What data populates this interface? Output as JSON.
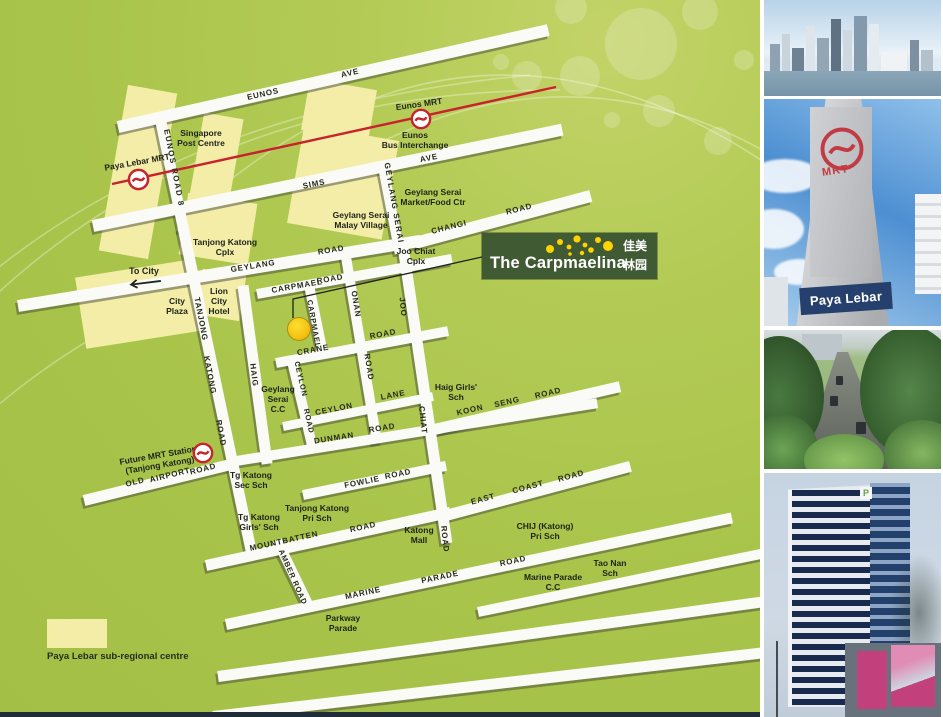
{
  "map": {
    "legend": {
      "label": "Paya Lebar sub-regional centre",
      "swatch_color": "#f3eda8"
    },
    "to_city": {
      "label": "To City"
    },
    "callout": {
      "title": "The Carpmaelina",
      "chinese_line1": "佳美",
      "chinese_line2": "林园",
      "bg_color": "#405a34",
      "dot_color": "#ffd200"
    },
    "mrt_line_color": "#c8232c",
    "road_labels": [
      {
        "t": "EUNOS",
        "x": 263,
        "y": 94,
        "rot": -12.7
      },
      {
        "t": "AVE",
        "x": 350,
        "y": 73,
        "rot": -12.7
      },
      {
        "t": "SIMS",
        "x": 314,
        "y": 184,
        "rot": -11.6
      },
      {
        "t": "AVE",
        "x": 429,
        "y": 158,
        "rot": -11.6
      },
      {
        "t": "GEYLANG",
        "x": 253,
        "y": 266,
        "rot": -9.2
      },
      {
        "t": "ROAD",
        "x": 331,
        "y": 250,
        "rot": -9.2
      },
      {
        "t": "CHANGI",
        "x": 449,
        "y": 227,
        "rot": -14
      },
      {
        "t": "ROAD",
        "x": 519,
        "y": 209,
        "rot": -14
      },
      {
        "t": "EUNOS ROAD 8",
        "x": 174,
        "y": 168,
        "rot": 79,
        "ls": 1.5
      },
      {
        "t": "GEYLANG SERAI",
        "x": 394,
        "y": 203,
        "rot": 80,
        "ls": 1.2
      },
      {
        "t": "CARPMAEL",
        "x": 297,
        "y": 286,
        "rot": -10
      },
      {
        "t": "ROAD",
        "x": 330,
        "y": 279,
        "rot": -10
      },
      {
        "t": "TANJONG",
        "x": 201,
        "y": 319,
        "rot": 79
      },
      {
        "t": "KATONG",
        "x": 210,
        "y": 375,
        "rot": 79
      },
      {
        "t": "ROAD",
        "x": 221,
        "y": 433,
        "rot": 79
      },
      {
        "t": "HAIG",
        "x": 254,
        "y": 375,
        "rot": 83
      },
      {
        "t": "CARPMAEL",
        "x": 314,
        "y": 324,
        "rot": 80,
        "fs": 7.5
      },
      {
        "t": "ONAN",
        "x": 356,
        "y": 304,
        "rot": 81
      },
      {
        "t": "ROAD",
        "x": 369,
        "y": 367,
        "rot": 81
      },
      {
        "t": "JOO",
        "x": 403,
        "y": 307,
        "rot": 84
      },
      {
        "t": "CHIAT",
        "x": 423,
        "y": 420,
        "rot": 84
      },
      {
        "t": "ROAD",
        "x": 445,
        "y": 539,
        "rot": 84
      },
      {
        "t": "CRANE",
        "x": 313,
        "y": 350,
        "rot": -10.5
      },
      {
        "t": "ROAD",
        "x": 383,
        "y": 334,
        "rot": -10.5
      },
      {
        "t": "CEYLON",
        "x": 301,
        "y": 379,
        "rot": 77,
        "fs": 7.5
      },
      {
        "t": "ROAD",
        "x": 309,
        "y": 421,
        "rot": 77,
        "fs": 7.5
      },
      {
        "t": "CEYLON",
        "x": 334,
        "y": 409,
        "rot": -11.3
      },
      {
        "t": "LANE",
        "x": 393,
        "y": 395,
        "rot": -11.3
      },
      {
        "t": "KOON",
        "x": 470,
        "y": 410,
        "rot": -13
      },
      {
        "t": "SENG",
        "x": 507,
        "y": 402,
        "rot": -13
      },
      {
        "t": "ROAD",
        "x": 548,
        "y": 393,
        "rot": -13
      },
      {
        "t": "DUNMAN",
        "x": 334,
        "y": 438,
        "rot": -9.1
      },
      {
        "t": "ROAD",
        "x": 382,
        "y": 428,
        "rot": -9.1
      },
      {
        "t": "OLD",
        "x": 135,
        "y": 482,
        "rot": -13.8
      },
      {
        "t": "AIRPORT",
        "x": 170,
        "y": 475,
        "rot": -13.8
      },
      {
        "t": "ROAD",
        "x": 203,
        "y": 469,
        "rot": -13.8
      },
      {
        "t": "FOWLIE",
        "x": 362,
        "y": 482,
        "rot": -11.5
      },
      {
        "t": "ROAD",
        "x": 398,
        "y": 474,
        "rot": -11.5
      },
      {
        "t": "EAST",
        "x": 483,
        "y": 499,
        "rot": -14.9
      },
      {
        "t": "COAST",
        "x": 528,
        "y": 487,
        "rot": -14.9
      },
      {
        "t": "ROAD",
        "x": 571,
        "y": 476,
        "rot": -14.9
      },
      {
        "t": "MOUNTBATTEN",
        "x": 284,
        "y": 541,
        "rot": -12.3
      },
      {
        "t": "ROAD",
        "x": 363,
        "y": 527,
        "rot": -12.3
      },
      {
        "t": "AMBER ROAD",
        "x": 293,
        "y": 577,
        "rot": 66,
        "fs": 7.5
      },
      {
        "t": "MARINE",
        "x": 363,
        "y": 593,
        "rot": -11.9
      },
      {
        "t": "PARADE",
        "x": 440,
        "y": 577,
        "rot": -11.9
      },
      {
        "t": "ROAD",
        "x": 513,
        "y": 561,
        "rot": -11.9
      }
    ],
    "poi_labels": [
      {
        "lines": [
          "Singapore",
          "Post Centre"
        ],
        "x": 201,
        "y": 138
      },
      {
        "lines": [
          "Paya Lebar MRT"
        ],
        "x": 137,
        "y": 162,
        "rot": -10
      },
      {
        "lines": [
          "Eunos MRT"
        ],
        "x": 419,
        "y": 104,
        "rot": -8
      },
      {
        "lines": [
          "Eunos",
          "Bus Interchange"
        ],
        "x": 415,
        "y": 140
      },
      {
        "lines": [
          "Geylang Serai",
          "Market/Food Ctr"
        ],
        "x": 433,
        "y": 197
      },
      {
        "lines": [
          "Geylang Serai",
          "Malay Village"
        ],
        "x": 361,
        "y": 220
      },
      {
        "lines": [
          "Joo Chiat",
          "Cplx"
        ],
        "x": 416,
        "y": 256
      },
      {
        "lines": [
          "Tanjong Katong",
          "Cplx"
        ],
        "x": 225,
        "y": 247
      },
      {
        "lines": [
          "City",
          "Plaza"
        ],
        "x": 177,
        "y": 306
      },
      {
        "lines": [
          "Lion",
          "City",
          "Hotel"
        ],
        "x": 219,
        "y": 301
      },
      {
        "lines": [
          "Geylang",
          "Serai",
          "C.C"
        ],
        "x": 278,
        "y": 399
      },
      {
        "lines": [
          "Haig Girls'",
          "Sch"
        ],
        "x": 456,
        "y": 392
      },
      {
        "lines": [
          "Future MRT Station",
          "(Tanjong Katong)"
        ],
        "x": 159,
        "y": 460,
        "rot": -10
      },
      {
        "lines": [
          "Tg Katong",
          "Sec Sch"
        ],
        "x": 251,
        "y": 480
      },
      {
        "lines": [
          "Tg Katong",
          "Girls' Sch"
        ],
        "x": 259,
        "y": 522
      },
      {
        "lines": [
          "Tanjong Katong",
          "Pri Sch"
        ],
        "x": 317,
        "y": 513
      },
      {
        "lines": [
          "Katong",
          "Mall"
        ],
        "x": 419,
        "y": 535
      },
      {
        "lines": [
          "CHIJ (Katong)",
          "Pri Sch"
        ],
        "x": 545,
        "y": 531
      },
      {
        "lines": [
          "Marine Parade",
          "C.C"
        ],
        "x": 553,
        "y": 582
      },
      {
        "lines": [
          "Tao Nan",
          "Sch"
        ],
        "x": 610,
        "y": 568
      },
      {
        "lines": [
          "Parkway",
          "Parade"
        ],
        "x": 343,
        "y": 623
      }
    ]
  },
  "photos": {
    "mrt_sign": {
      "logo_text": "MRT",
      "station_label": "Paya Lebar"
    },
    "tower_logo_text": "P"
  }
}
